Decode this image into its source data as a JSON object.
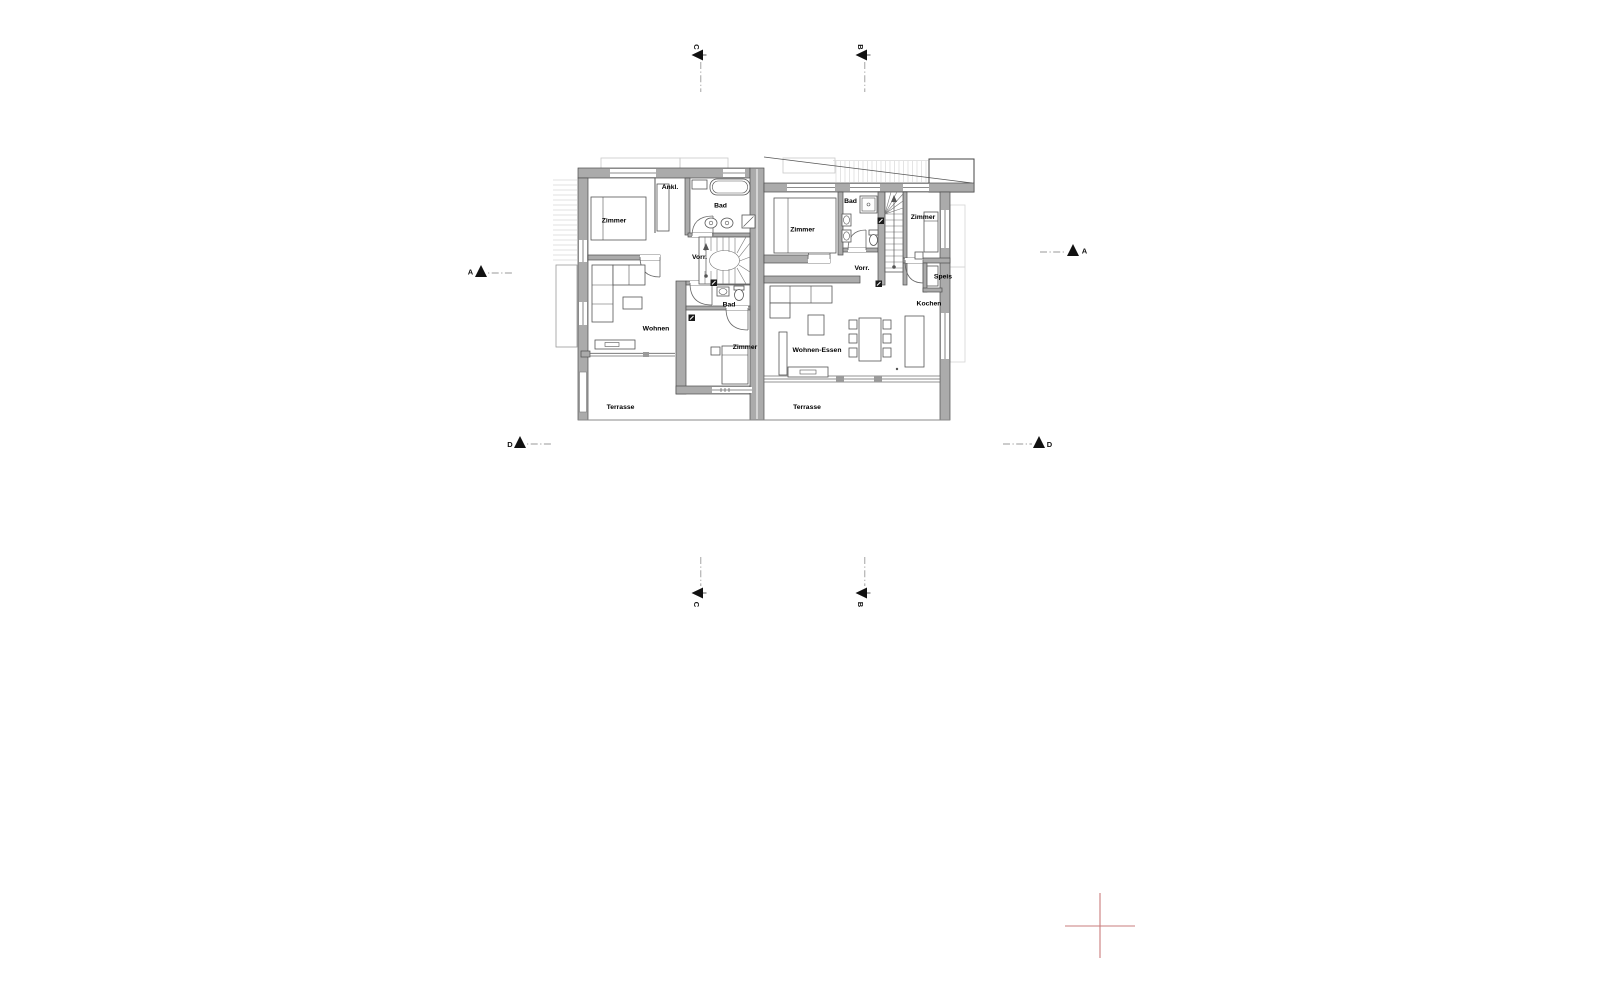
{
  "drawing_type": "architectural-floor-plan-duplex-ground-floor",
  "floor": {
    "unit_left": {
      "rooms": [
        "Zimmer",
        "Ankl.",
        "Bad",
        "Vorr.",
        "Wohnen",
        "Bad",
        "Zimmer",
        "Terrasse"
      ]
    },
    "unit_right": {
      "rooms": [
        "Zimmer",
        "Bad",
        "Zimmer",
        "Vorr.",
        "Speis",
        "Kochen",
        "Wohnen-Essen",
        "Terrasse"
      ]
    }
  },
  "labels": {
    "left_zimmer_nw": "Zimmer",
    "left_ankleide": "Ankl.",
    "left_bad_top": "Bad",
    "left_vorraum": "Vorr.",
    "left_wohnen": "Wohnen",
    "left_bad_lower": "Bad",
    "left_zimmer_s": "Zimmer",
    "left_terrasse": "Terrasse",
    "right_zimmer_w": "Zimmer",
    "right_bad": "Bad",
    "right_zimmer_e": "Zimmer",
    "right_vorraum": "Vorr.",
    "right_speis": "Speis",
    "right_kochen": "Kochen",
    "right_wohnen_essen": "Wohnen-Essen",
    "right_terrasse": "Terrasse"
  },
  "section_markers": {
    "a": "A",
    "b": "B",
    "c": "C",
    "d": "D"
  },
  "colors": {
    "background": "#ffffff",
    "wall_fill": "#ababab",
    "wall_outline": "#4d4d4d",
    "light_context_line": "#c9c9c9",
    "marker_black": "#111111",
    "registration_cross_red": "#c97c7c"
  }
}
